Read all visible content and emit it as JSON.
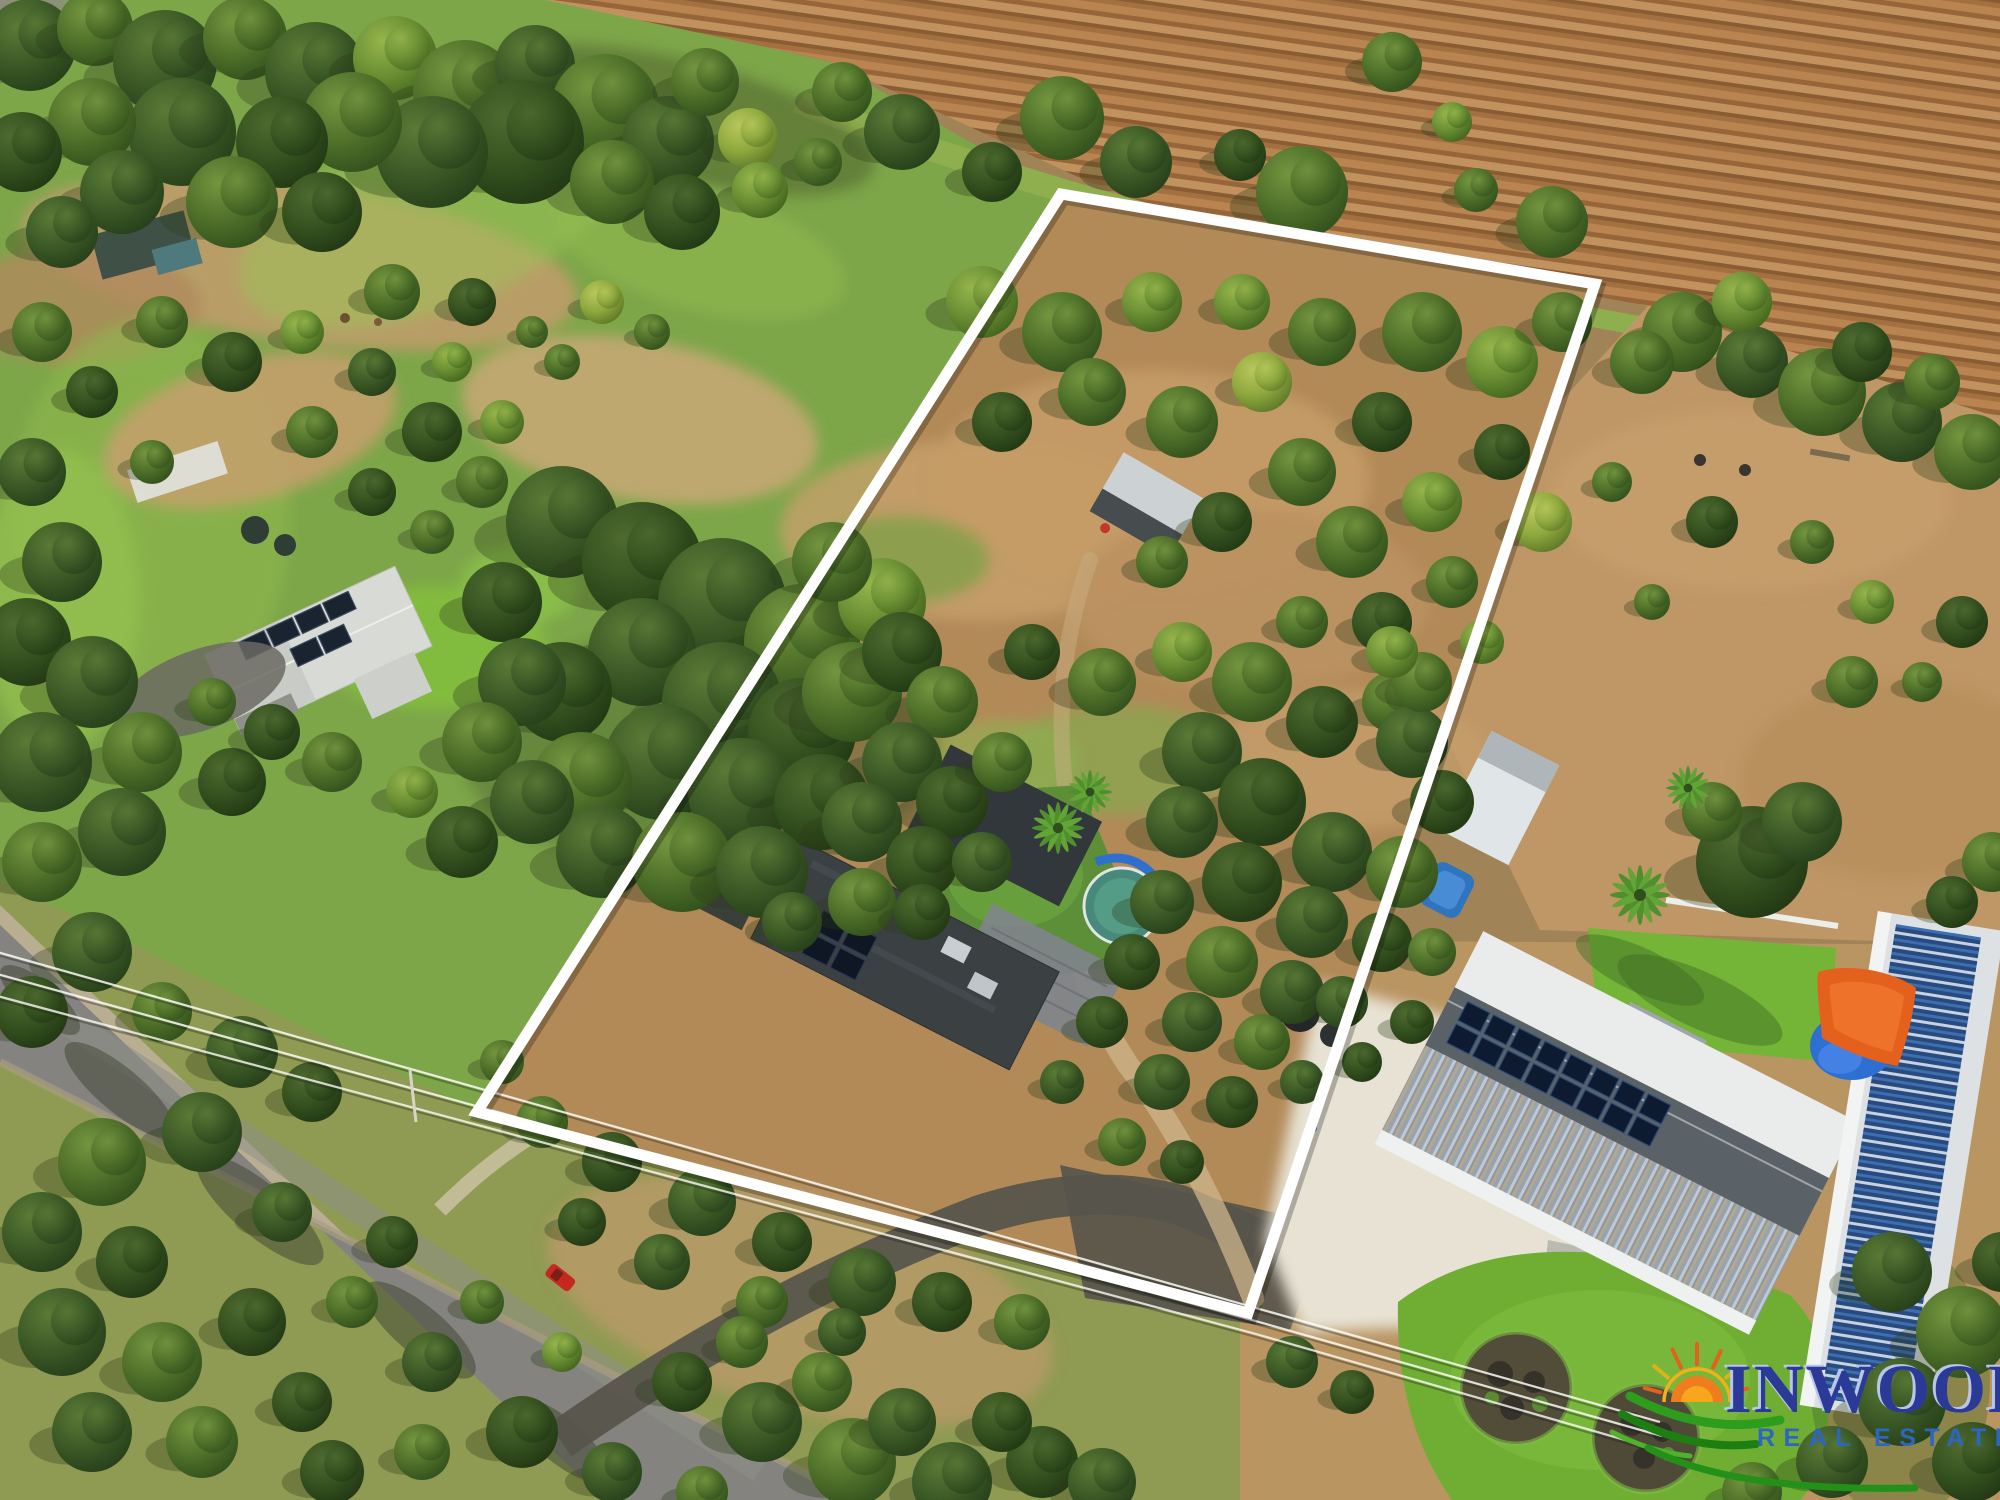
{
  "page": {
    "type": "aerial-property-photograph"
  },
  "photo": {
    "subject": "Aerial drone photo of a rural property marked with a white boundary outline; ploughed field at top, tree-lined paddocks, central house with round pool, road with power lines at lower left, neighbouring sheds with solar panels and lawn at lower right",
    "boundary_outline": {
      "color": "#ffffff",
      "corners_px": [
        [
          1061,
          194
        ],
        [
          1595,
          284
        ],
        [
          1248,
          1313
        ],
        [
          477,
          1112
        ]
      ]
    }
  },
  "watermark_logo": {
    "title": "INWOOD",
    "subtitle": "REAL ESTATE",
    "title_color": "#2b3a96",
    "title_bevel_color": "#b9c6ea",
    "subtitle_color": "#2d66c0",
    "sun_color": "#ef7d1d",
    "ray_color": "#e2611c",
    "swoosh_color": "#1f8f16"
  },
  "palette": {
    "field_brown": "#ab7743",
    "grass_green": "#7da649",
    "tree_dark": "#3c5a26",
    "tree_light": "#96b44c",
    "dirt_tan": "#c49b66",
    "road_grey": "#84837f",
    "roof_dark": "#3b4043",
    "roof_white": "#e9eceb",
    "pool_teal": "#47897a",
    "sail_orange": "#e4601d",
    "solar_blue": "#2c4e85",
    "lawn_green": "#6fae33",
    "gravel_white": "#e7e2d4"
  }
}
